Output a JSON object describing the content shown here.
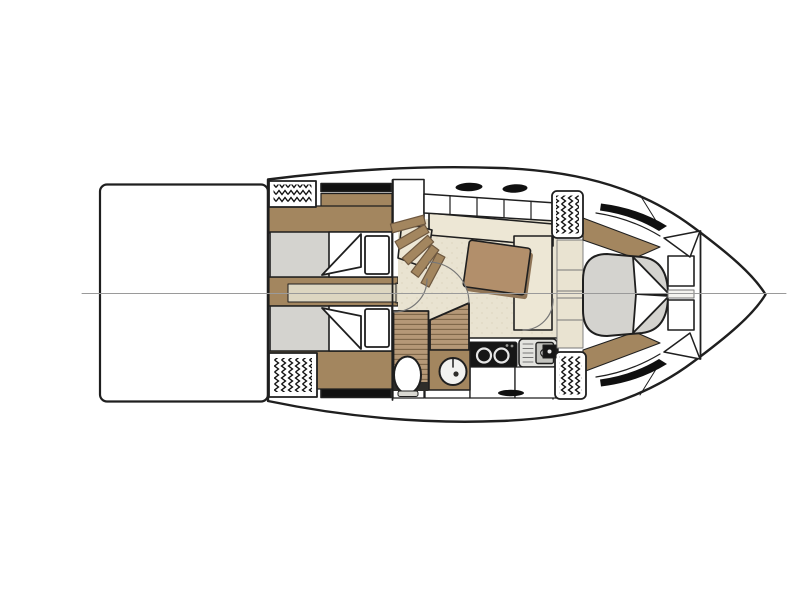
{
  "figure": {
    "type": "floor-plan",
    "subject": "motor-yacht lower-deck interior layout, top-down view, bow pointing right",
    "background": "#ffffff"
  },
  "legend": {
    "areas": [
      "swim-platform",
      "transom-vent-hatches",
      "aft-cabin-twin-berths",
      "companionway-staircase",
      "wet-head-with-toilet-and-washbasin",
      "salon-dinette-with-table",
      "galley-with-cooktop-and-sink",
      "forward-cabin-island-berth",
      "bow-deck"
    ]
  },
  "colors": {
    "outline": "#1f1f1f",
    "centerline": "#9a9a9a",
    "white": "#ffffff",
    "offwhite": "#f4f3ef",
    "wood": "#a3865f",
    "wood_edge": "#6e5840",
    "teak": "#b59877",
    "teak_line": "#7d6548",
    "table": "#b28f6b",
    "table_shadow": "#8f7456",
    "bed_gray": "#d4d3cf",
    "floor_beige": "#e9e3d1",
    "floor_speck": "#d9d1ba",
    "cushion_cream": "#ede7d5",
    "walkway": "#ddd6c1",
    "black": "#101010",
    "appliance_black": "#161616",
    "burner_ring": "#e6e6e6",
    "metal_light": "#e3e3df",
    "sink_gray": "#c4c4bf",
    "drain_light": "#f2f2f0",
    "arc_gray": "#777777",
    "dark_floor": "#2e2d2a",
    "toilet_base": "#d9d8d2",
    "knob_gray": "#9a9a96"
  }
}
